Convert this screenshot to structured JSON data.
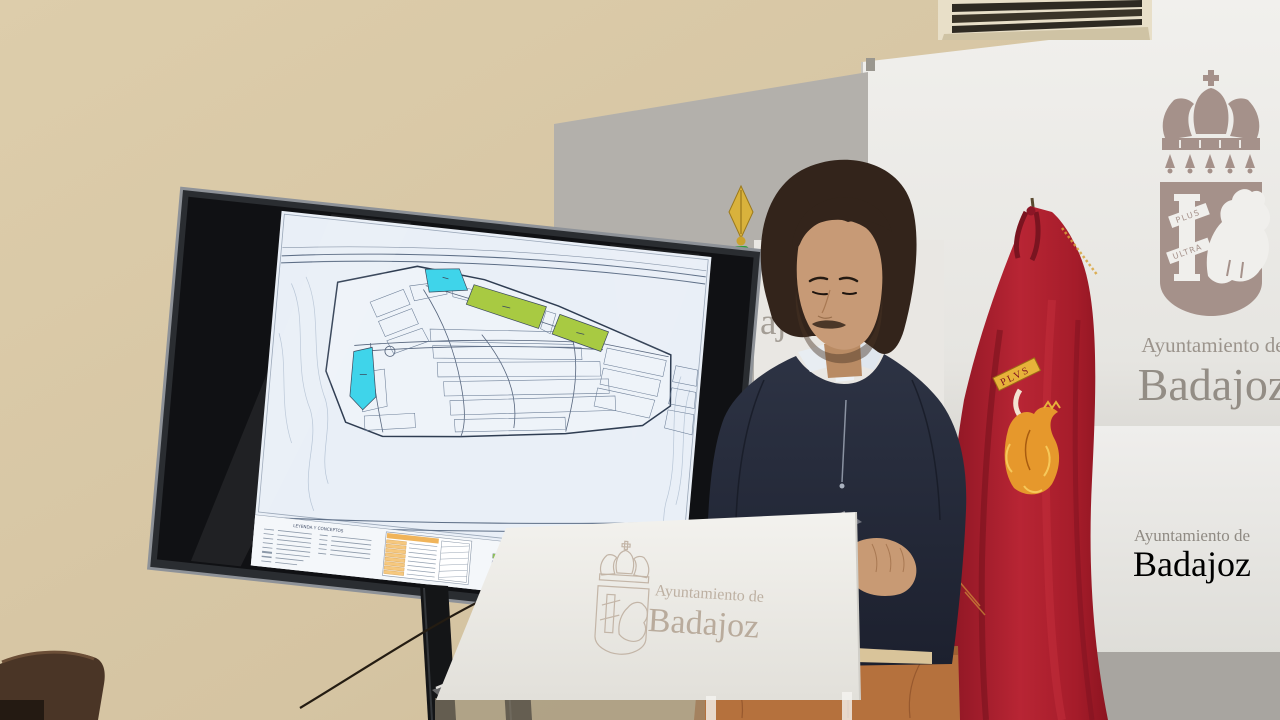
{
  "backdrop": {
    "main_panel": {
      "org": "Ayuntamiento de",
      "city": "Badajoz",
      "coat_of_arms": {
        "motto_top": "PLUS",
        "motto_bottom": "ULTRA"
      }
    },
    "lower_panel": {
      "org": "Ayuntamiento de",
      "city": "Badajoz"
    },
    "middle_banner": {
      "visible_fragment_line1": "nien",
      "visible_fragment_line2": "ajo"
    }
  },
  "podium": {
    "org": "Ayuntamiento de",
    "city": "Badajoz"
  },
  "flag": {
    "scroll_text": "PLVS"
  },
  "tv": {
    "brand_logo": "mi",
    "map": {
      "legend_left_title": "LEYENDA Y CONCEPTOS",
      "legend_right_title": "USOS PORMENORIZADOS",
      "zone_colors": {
        "cyan": "#3fd4ea",
        "green": "#a8ca42"
      },
      "legend_swatches_col1": [
        "#8fbf5a",
        "#a893d6",
        "#63b96a",
        "#2a7f72",
        "#2b3990"
      ],
      "legend_swatches_col2": [
        "#a9d46a",
        "#52b6a6",
        "#45c8de",
        "#1f9488",
        "#cf7fc2"
      ],
      "legend_table_orange": "#f0b45a"
    }
  },
  "colors": {
    "flag_red": "#b02330",
    "embroidery_gold": "#e7b23a",
    "wall_beige": "#d8c7a5",
    "panel_white": "#eeedea",
    "emblem_taupe": "#a5918a",
    "sweater_navy": "#272c3c",
    "trousers_tan": "#b5713d"
  }
}
